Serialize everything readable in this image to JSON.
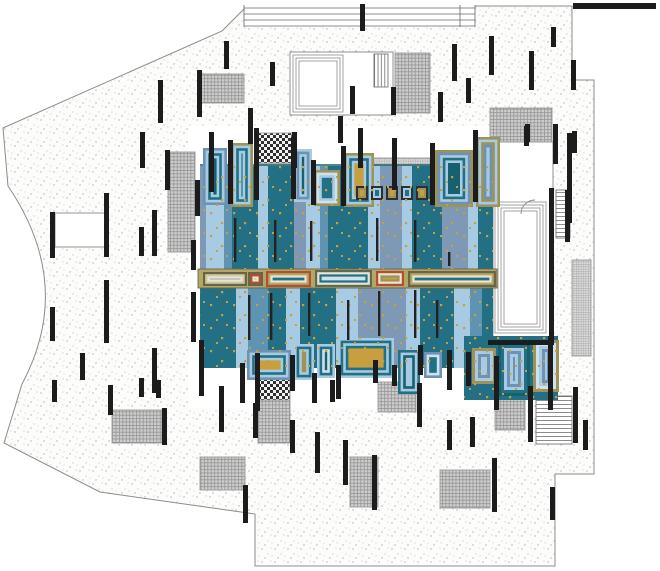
{
  "meta": {
    "title": "architectural-site-plan",
    "canvas": {
      "w": 660,
      "h": 571
    }
  },
  "palette": {
    "teal": "#237084",
    "deep": "#16606f",
    "light": "#a7cbe2",
    "mid": "#5e93b2",
    "slate": "#7d99b6",
    "pale": "#cfe0ee",
    "olive": "#9d9259",
    "band": "#b3a768",
    "cream": "#e9e5d2",
    "gold": "#c79f3e",
    "orange": "#b14f2f",
    "maroon": "#7a4350",
    "wall": "#1c1c1c",
    "outline": "#8c8c8c",
    "ground": "#fcfcfb"
  },
  "site": {
    "outline_path": "M222 31 L247 6 L572 6 L572 80 L594 80 L594 474 L555 474 L555 566 L255 566 L255 514 L100 492 L4 443 L22 384 Q75 285 8 186 L3 128 Z",
    "apron": [
      188,
      126,
      316,
      282
    ],
    "top_band": {
      "rect": [
        244,
        5,
        231,
        22
      ],
      "line_ys": [
        8,
        14,
        20,
        26
      ],
      "x1": 244,
      "x2": 475,
      "tick_xs": [
        244,
        460,
        475
      ]
    }
  },
  "buildings": {
    "pavilion_outer": [
      290,
      52,
      103,
      63
    ],
    "pavilion_nested": [
      [
        293,
        55,
        50,
        57
      ],
      [
        296,
        58,
        44,
        51
      ],
      [
        299,
        61,
        38,
        45
      ]
    ],
    "right_room_outer": [
      493,
      142,
      60,
      203
    ],
    "right_terrace_nested": [
      [
        495,
        202,
        51,
        131
      ],
      [
        498,
        205,
        45,
        125
      ],
      [
        501,
        208,
        39,
        119
      ],
      [
        504,
        211,
        33,
        113
      ]
    ],
    "mid_left_rect": [
      55,
      213,
      53,
      34
    ],
    "door_arc": "M521 214 A14 14 0 0 1 535 200"
  },
  "hatches": [
    [
      200,
      74,
      44,
      29,
      "cross"
    ],
    [
      395,
      53,
      35,
      60,
      "cross"
    ],
    [
      490,
      108,
      62,
      34,
      "cross"
    ],
    [
      168,
      152,
      27,
      100,
      "cross"
    ],
    [
      352,
      158,
      78,
      14,
      "fine"
    ],
    [
      352,
      172,
      78,
      14,
      "checker"
    ],
    [
      258,
      133,
      34,
      30,
      "checker"
    ],
    [
      258,
      163,
      34,
      36,
      "fine"
    ],
    [
      112,
      410,
      50,
      33,
      "cross"
    ],
    [
      200,
      457,
      45,
      33,
      "cross"
    ],
    [
      258,
      378,
      32,
      22,
      "checker"
    ],
    [
      258,
      400,
      32,
      43,
      "cross"
    ],
    [
      378,
      382,
      38,
      30,
      "cross"
    ],
    [
      350,
      457,
      28,
      50,
      "cross"
    ],
    [
      440,
      470,
      50,
      38,
      "cross"
    ],
    [
      495,
      397,
      30,
      33,
      "cross"
    ],
    [
      572,
      260,
      19,
      96,
      "fine"
    ]
  ],
  "stairs": [
    [
      556,
      190,
      14,
      48,
      "hlines"
    ],
    [
      536,
      396,
      36,
      48,
      "hlines"
    ],
    [
      374,
      54,
      14,
      33,
      "vlines"
    ]
  ],
  "pool": {
    "upper": {
      "y": 166,
      "h": 103,
      "stripes": [
        [
          200,
          6,
          "slate"
        ],
        [
          206,
          18,
          "light"
        ],
        [
          224,
          8,
          "mid"
        ],
        [
          232,
          26,
          "teal"
        ],
        [
          258,
          10,
          "light"
        ],
        [
          268,
          26,
          "teal"
        ],
        [
          294,
          12,
          "slate"
        ],
        [
          306,
          14,
          "light"
        ],
        [
          320,
          8,
          "mid"
        ],
        [
          328,
          40,
          "teal"
        ],
        [
          368,
          12,
          "light"
        ],
        [
          380,
          22,
          "slate"
        ],
        [
          402,
          10,
          "light"
        ],
        [
          412,
          30,
          "teal"
        ],
        [
          442,
          26,
          "slate"
        ],
        [
          468,
          10,
          "light"
        ],
        [
          478,
          15,
          "teal"
        ]
      ]
    },
    "lower": {
      "y": 288,
      "h": 80,
      "stripes": [
        [
          200,
          36,
          "teal"
        ],
        [
          236,
          12,
          "light"
        ],
        [
          248,
          20,
          "mid"
        ],
        [
          268,
          18,
          "teal"
        ],
        [
          286,
          14,
          "light"
        ],
        [
          300,
          36,
          "teal"
        ],
        [
          336,
          22,
          "light"
        ],
        [
          358,
          48,
          "slate"
        ],
        [
          406,
          14,
          "light"
        ],
        [
          420,
          34,
          "teal"
        ],
        [
          454,
          16,
          "light"
        ],
        [
          470,
          12,
          "mid"
        ],
        [
          482,
          11,
          "teal"
        ]
      ]
    },
    "dot_areas": [
      [
        200,
        166,
        293,
        103
      ],
      [
        200,
        288,
        293,
        80
      ],
      [
        464,
        336,
        94,
        64
      ]
    ],
    "top_edge": [
      200,
      165,
      493,
      165
    ],
    "band": {
      "rect": [
        198,
        269,
        299,
        19
      ],
      "lozenges": [
        [
          203,
          272,
          44,
          14,
          "olive"
        ],
        [
          248,
          272,
          15,
          14,
          "orangesq"
        ],
        [
          266,
          271,
          45,
          16,
          "orange"
        ],
        [
          315,
          270,
          57,
          17,
          "tealz"
        ],
        [
          376,
          271,
          28,
          15,
          "orange2"
        ],
        [
          408,
          271,
          88,
          16,
          "maroon"
        ]
      ]
    },
    "cabanas_top": [
      [
        203,
        148,
        24,
        57,
        "slate-teal"
      ],
      [
        231,
        143,
        22,
        64,
        "olive-stripes"
      ],
      [
        294,
        149,
        18,
        53,
        "slate-teal2"
      ],
      [
        314,
        170,
        26,
        36,
        "olive-light"
      ],
      [
        344,
        153,
        30,
        54,
        "olive-gold"
      ],
      [
        435,
        150,
        38,
        57,
        "rings5"
      ],
      [
        476,
        137,
        24,
        70,
        "vstripes"
      ]
    ],
    "small_boxes": {
      "y": 186,
      "h": 14,
      "w": 12,
      "xs": [
        356,
        371,
        386,
        401,
        416
      ],
      "styles": [
        "smallbox-olive",
        "smallbox-teal",
        "smallbox-olive",
        "smallbox-teal",
        "smallbox-olive"
      ]
    },
    "cabanas_bottom": [
      [
        247,
        350,
        44,
        30,
        "slate-gold"
      ],
      [
        294,
        344,
        20,
        36,
        "light-olive"
      ],
      [
        317,
        344,
        18,
        34,
        "light-teal"
      ],
      [
        338,
        338,
        56,
        40,
        "big-gold"
      ],
      [
        398,
        350,
        22,
        44,
        "teal-light"
      ],
      [
        424,
        352,
        18,
        26,
        "small2"
      ]
    ],
    "cluster_bg": [
      464,
      336,
      94,
      64
    ],
    "cluster": [
      [
        472,
        348,
        24,
        36,
        "k-light"
      ],
      [
        498,
        342,
        32,
        54,
        "k-big"
      ],
      [
        533,
        340,
        26,
        52,
        "k-right"
      ]
    ]
  },
  "styles": {
    "cabana": {
      "slate-teal": [
        "#6d92b4",
        "#a7cbe2",
        "#237084",
        "#a7cbe2",
        "#16606f"
      ],
      "olive-stripes": [
        "#9d9259",
        "#a7cbe2",
        "#237084",
        "#a7cbe2",
        "#237084"
      ],
      "slate-teal2": [
        "#a7cbe2",
        "#6d92b4",
        "#a7cbe2",
        "#16606f"
      ],
      "olive-light": [
        "#9d9259",
        "#cfe0ee",
        "#a7cbe2",
        "#237084"
      ],
      "olive-gold": [
        "#9d9259",
        "#a7cbe2",
        "#237084",
        "#a7cbe2",
        "#c79f3e"
      ],
      "rings5": [
        "#9d9259",
        "#6d92b4",
        "#a7cbe2",
        "#237084",
        "#a7cbe2",
        "#16606f"
      ],
      "vstripes": [
        "#9d9259",
        "#a7cbe2",
        "#9d9259",
        "#6d92b4",
        "#a7cbe2"
      ],
      "slate-gold": [
        "#6d92b4",
        "#a7cbe2",
        "#237084",
        "#a7cbe2",
        "#c79f3e"
      ],
      "light-olive": [
        "#a7cbe2",
        "#237084",
        "#a7cbe2",
        "#9d9259"
      ],
      "light-teal": [
        "#a7cbe2",
        "#237084",
        "#cfe0ee",
        "#16606f"
      ],
      "big-gold": [
        "#a7cbe2",
        "#237084",
        "#a7cbe2",
        "#237084",
        "#c79f3e"
      ],
      "teal-light": [
        "#237084",
        "#a7cbe2",
        "#16606f",
        "#a7cbe2"
      ],
      "small2": [
        "#6d92b4",
        "#cfe0ee",
        "#237084"
      ],
      "k-light": [
        "#9d9259",
        "#a7cbe2",
        "#6d92b4",
        "#a7cbe2",
        "#237084"
      ],
      "k-big": [
        "#16606f",
        "#237084",
        "#a7cbe2",
        "#6d92b4",
        "#a7cbe2",
        "#6d92b4"
      ],
      "k-right": [
        "#9d9259",
        "#cfe0ee",
        "#a7cbe2",
        "#6d92b4",
        "#a7cbe2",
        "#6d92b4"
      ],
      "smallbox-olive": [
        "#2f2f2f",
        "#9d9259",
        "#c79f3e"
      ],
      "smallbox-teal": [
        "#2f2f2f",
        "#a7cbe2",
        "#237084"
      ]
    },
    "lozenge": {
      "olive": [
        "#6b6345",
        "#cfc99f",
        "#e9e5d2",
        "#7d99b6",
        "#a7cbe2"
      ],
      "orangesq": [
        "#6b6345",
        "#b14f2f",
        "#e9e5d2",
        "#c79f3e"
      ],
      "orange": [
        "#b14f2f",
        "#b3a768",
        "#e9e5d2",
        "#237084",
        "#a7cbe2"
      ],
      "tealz": [
        "#5d6b52",
        "#e9e5d2",
        "#237084",
        "#cfe0ee",
        "#6d92b4"
      ],
      "orange2": [
        "#b14f2f",
        "#e9e5d2",
        "#9d9259",
        "#c79f3e"
      ],
      "maroon": [
        "#6b6345",
        "#b3a768",
        "#e9e5d2",
        "#237084",
        "#7a4350"
      ]
    }
  },
  "bars": [
    [
      140,
      132,
      36
    ],
    [
      158,
      80,
      43
    ],
    [
      197,
      70,
      47
    ],
    [
      165,
      150,
      40
    ],
    [
      224,
      41,
      28
    ],
    [
      270,
      62,
      24
    ],
    [
      248,
      108,
      36
    ],
    [
      292,
      132,
      36
    ],
    [
      338,
      116,
      27
    ],
    [
      350,
      86,
      28
    ],
    [
      360,
      4,
      27
    ],
    [
      391,
      87,
      28
    ],
    [
      438,
      92,
      30
    ],
    [
      452,
      44,
      37
    ],
    [
      466,
      78,
      25
    ],
    [
      489,
      36,
      39
    ],
    [
      529,
      51,
      39
    ],
    [
      551,
      27,
      20
    ],
    [
      571,
      60,
      30
    ],
    [
      525,
      124,
      18
    ],
    [
      553,
      124,
      40
    ],
    [
      572,
      131,
      22
    ],
    [
      50,
      212,
      46
    ],
    [
      104,
      193,
      64
    ],
    [
      152,
      210,
      46
    ],
    [
      139,
      227,
      29
    ],
    [
      50,
      307,
      34
    ],
    [
      104,
      280,
      63
    ],
    [
      152,
      348,
      45
    ],
    [
      80,
      353,
      27
    ],
    [
      52,
      380,
      22
    ],
    [
      139,
      378,
      19
    ],
    [
      156,
      380,
      18
    ],
    [
      108,
      385,
      30
    ],
    [
      162,
      408,
      37
    ],
    [
      219,
      386,
      46
    ],
    [
      243,
      485,
      38
    ],
    [
      253,
      403,
      35
    ],
    [
      290,
      420,
      33
    ],
    [
      315,
      432,
      41
    ],
    [
      330,
      380,
      22
    ],
    [
      343,
      440,
      45
    ],
    [
      372,
      455,
      55
    ],
    [
      417,
      383,
      44
    ],
    [
      447,
      420,
      30
    ],
    [
      470,
      417,
      30
    ],
    [
      492,
      458,
      54
    ],
    [
      528,
      390,
      52
    ],
    [
      573,
      387,
      56
    ],
    [
      550,
      487,
      33
    ],
    [
      583,
      420,
      30
    ],
    [
      195,
      180,
      36
    ],
    [
      191,
      240,
      30
    ],
    [
      191,
      292,
      50
    ],
    [
      209,
      132,
      60
    ],
    [
      228,
      140,
      64
    ],
    [
      254,
      128,
      72
    ],
    [
      291,
      137,
      62
    ],
    [
      311,
      160,
      45
    ],
    [
      341,
      146,
      60
    ],
    [
      358,
      128,
      40
    ],
    [
      392,
      138,
      52
    ],
    [
      430,
      143,
      62
    ],
    [
      473,
      130,
      72
    ],
    [
      199,
      340,
      56
    ],
    [
      240,
      363,
      40
    ],
    [
      255,
      353,
      58
    ],
    [
      290,
      355,
      36
    ],
    [
      312,
      373,
      30
    ],
    [
      336,
      365,
      34
    ],
    [
      373,
      360,
      23
    ],
    [
      392,
      365,
      21
    ],
    [
      418,
      345,
      30
    ],
    [
      447,
      350,
      40
    ],
    [
      466,
      352,
      34
    ],
    [
      494,
      356,
      54
    ],
    [
      528,
      386,
      26
    ],
    [
      548,
      336,
      74
    ],
    [
      567,
      133,
      90
    ],
    [
      549,
      188,
      157
    ],
    [
      524,
      126,
      20
    ],
    [
      565,
      190,
      52
    ]
  ],
  "hbars": [
    [
      488,
      340,
      66,
      5
    ],
    [
      573,
      3,
      83,
      6
    ]
  ],
  "lanes": [
    [
      234,
      218,
      44
    ],
    [
      274,
      220,
      42
    ],
    [
      310,
      221,
      40
    ],
    [
      376,
      218,
      43
    ],
    [
      414,
      220,
      42
    ],
    [
      448,
      252,
      14
    ],
    [
      270,
      293,
      47
    ],
    [
      308,
      293,
      43
    ],
    [
      347,
      300,
      40
    ],
    [
      378,
      291,
      45
    ],
    [
      414,
      290,
      48
    ],
    [
      248,
      295,
      45
    ],
    [
      436,
      300,
      38
    ]
  ]
}
